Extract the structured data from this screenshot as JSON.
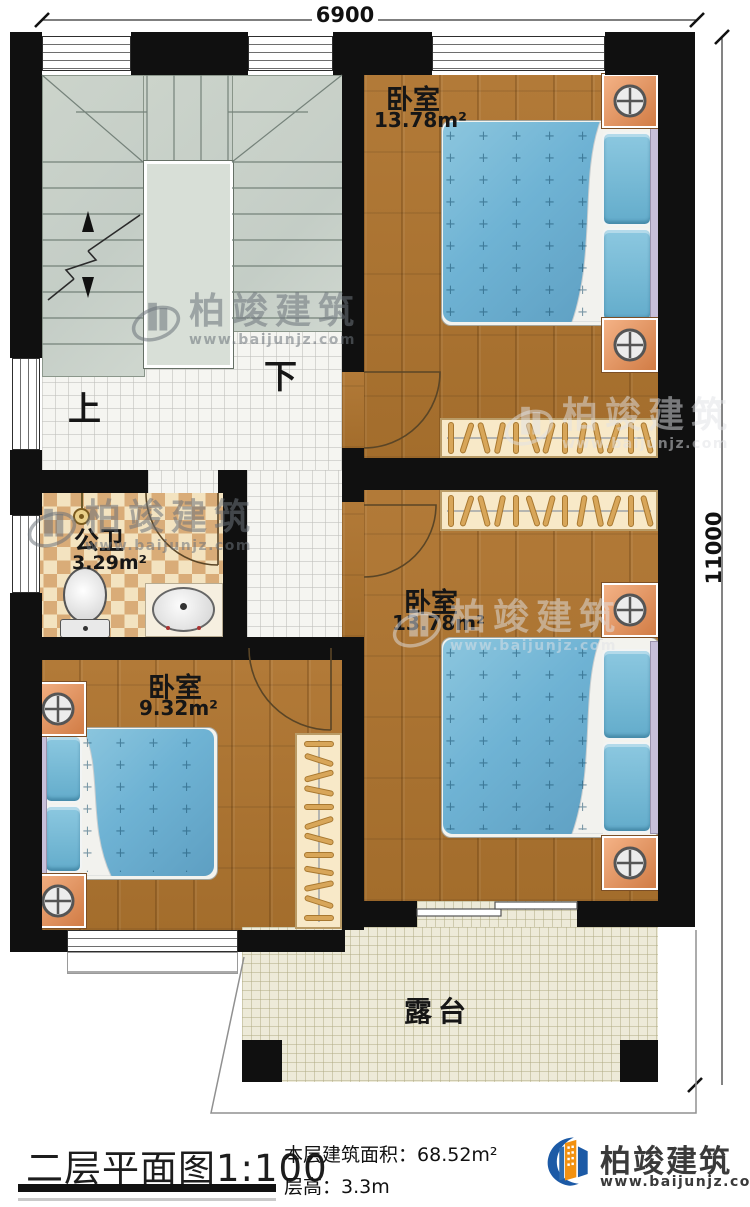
{
  "plan": {
    "dimension_top": "6900",
    "dimension_right": "11000",
    "rooms": {
      "bedroom_top": {
        "label": "卧室",
        "area": "13.78m²"
      },
      "bedroom_middle": {
        "label": "卧室",
        "area": "13.78m²"
      },
      "bedroom_small": {
        "label": "卧室",
        "area": "9.32m²"
      },
      "bathroom": {
        "label": "公卫",
        "area": "3.29m²"
      },
      "terrace": {
        "label": "露台"
      }
    },
    "stairs": {
      "up": "上",
      "down": "下"
    }
  },
  "watermark": {
    "name": "柏竣建筑",
    "website": "www.baijunjz.com"
  },
  "footer": {
    "sheet_title": "二层平面图",
    "scale": "1:100",
    "area_label": "本层建筑面积：",
    "area_value": "68.52m²",
    "floor_height_label": "层高：",
    "floor_height_value": "3.3m",
    "brand_name": "柏竣建筑",
    "brand_website": "www.baijunjz.com"
  },
  "colors": {
    "wall": "#101010",
    "wood_floor": "#ab7433",
    "hall_tile": "#f4f4f0",
    "bathroom_tile_light": "#f3e3c0",
    "bathroom_tile_dark": "#d9ac78",
    "terrace_tile": "#edead8",
    "stair": "#cbd3ca",
    "bed_blue": "#71b4d4",
    "nightstand_orange": "#e2915c",
    "wardrobe_cream": "#f8e9c8",
    "logo_blue": "#1c5aa6",
    "logo_orange": "#f29111"
  }
}
